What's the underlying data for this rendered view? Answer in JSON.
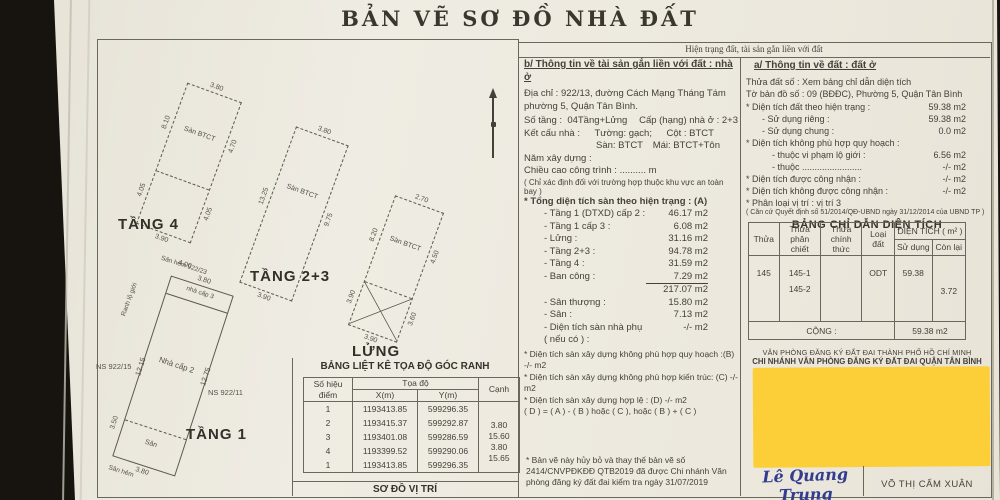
{
  "title": "BẢN VẼ SƠ ĐỒ NHÀ ĐẤT",
  "status_header": "Hiện trạng đất, tài sản gắn liền với đất",
  "building_info": {
    "heading": "b/ Thông tin về tài sản gắn liền với đất : nhà ở",
    "address1": "Địa chỉ : 922/13, đường Cách Mạng Tháng Tám",
    "address2": "phường 5, Quận Tân Bình.",
    "floors_label": "Số tầng :",
    "floors_value": "04Tầng+Lửng",
    "grade": "Cấp (hạng) nhà ở : 2+3",
    "structure_label": "Kết cấu nhà :",
    "wall": "Tường: gạch;",
    "column": "Cột : BTCT",
    "floor": "Sàn: BTCT",
    "roof": "Mái: BTCT+Tôn",
    "year": "Năm xây dựng :",
    "height": "Chiều cao công trình : .......... m",
    "height_note": "( Chỉ xác định đối với trường hợp thuộc khu vực an toàn bay )",
    "total_heading": "* Tổng diện tích sàn theo hiện trạng : (A)",
    "area_rows": [
      {
        "label": "- Tầng 1 (DTXD) cấp 2 :",
        "value": "46.17 m2"
      },
      {
        "label": "- Tầng 1 cấp 3 :",
        "value": "6.08 m2"
      },
      {
        "label": "- Lửng :",
        "value": "31.16 m2"
      },
      {
        "label": "- Tầng 2+3 :",
        "value": "94.78 m2"
      },
      {
        "label": "- Tầng 4 :",
        "value": "31.59 m2"
      },
      {
        "label": "- Ban công :",
        "value": "7.29 m2"
      }
    ],
    "subtotal": "217.07 m2",
    "extra_rows": [
      {
        "label": "- Sân thượng :",
        "value": "15.80 m2"
      },
      {
        "label": "- Sân :",
        "value": "7.13 m2"
      },
      {
        "label": "- Diện tích sàn nhà phụ ( nếu có ) :",
        "value": "-/- m2"
      }
    ],
    "note_b": "* Diện tích sàn xây dựng không phù hợp quy hoạch :(B) -/- m2",
    "note_c": "* Diện tích sàn xây dựng không phù hợp kiến trúc: (C) -/- m2",
    "note_d": "* Diện tích sàn xây dựng hợp lệ : (D)    -/- m2",
    "note_formula": "( D ) = ( A ) - ( B ) hoặc ( C ), hoặc ( B ) + ( C )",
    "footnote": "* Bản vẽ này hủy bỏ và thay thế bản vẽ số 2414/CNVPĐKĐĐ QTB2019 đã được Chi nhánh Văn phòng đăng ký đất đai kiểm tra ngày 31/07/2019"
  },
  "land_info": {
    "heading": "a/ Thông tin về đất : đất ở",
    "parcel": "Thửa đất số : Xem bảng chỉ dẫn diện tích",
    "map_sheet": "Tờ bản đồ số : 09 (BĐĐC), Phường 5, Quận Tân Bình",
    "rows": [
      {
        "label": "* Diện tích đất theo hiện trạng :",
        "value": "59.38 m2"
      },
      {
        "label": "- Sử dụng riêng :",
        "value": "59.38 m2"
      },
      {
        "label": "- Sử dụng chung :",
        "value": "0.0 m2"
      },
      {
        "label": "* Diện tích không phù hợp quy hoạch :",
        "value": ""
      },
      {
        "label": "- thuộc vi phạm lộ giới :",
        "value": "6.56 m2"
      },
      {
        "label": "- thuộc ........................",
        "value": "-/- m2"
      },
      {
        "label": "* Diện tích được công nhận :",
        "value": "-/- m2"
      },
      {
        "label": "* Diện tích không được công nhận :",
        "value": "-/- m2"
      },
      {
        "label": "* Phân loại vị trí : vị trí 3",
        "value": ""
      }
    ],
    "legal_ref": "( Căn cứ Quyết định số 51/2014/QĐ-UBND ngày 31/12/2014 của UBND TP )"
  },
  "area_table": {
    "title": "BẢNG CHỈ DẪN DIỆN TÍCH",
    "col_thua": "Thửa",
    "col_phan_chiet_1": "Thửa",
    "col_phan_chiet_2": "phân chiết",
    "col_chinh_thuc_1": "Thửa",
    "col_chinh_thuc_2": "chính thức",
    "col_loai_dat": "Loại đất",
    "col_dien_tich": "DIỆN TÍCH ( m² )",
    "col_su_dung": "Sử dụng",
    "col_con_lai": "Còn lại",
    "row": {
      "thua": "145",
      "phan_chiet1": "145-1",
      "phan_chiet2": "145-2",
      "chinh_thuc": "",
      "loai_dat": "ODT",
      "su_dung": "59.38",
      "con_lai": "3.72"
    },
    "total_label": "CỘNG :",
    "total_value": "59.38 m2"
  },
  "office": {
    "line1": "VĂN PHÒNG ĐĂNG KÝ ĐẤT ĐAI THÀNH PHỐ HỒ CHÍ MINH",
    "line2": "CHI NHÁNH VĂN PHÒNG ĐĂNG KÝ ĐẤT ĐAI QUẬN TÂN BÌNH"
  },
  "signatures": {
    "script": "Lê Quang Trung",
    "name": "VÕ THỊ CẨM XUÂN"
  },
  "coord_table": {
    "title": "BẢNG LIỆT KÊ TỌA ĐỘ GÓC RANH",
    "col_point_1": "Số hiệu",
    "col_point_2": "điểm",
    "col_toado": "Tọa độ",
    "col_x": "X(m)",
    "col_y": "Y(m)",
    "col_canh": "Cạnh",
    "rows": [
      {
        "p": "1",
        "x": "1193413.85",
        "y": "599296.35"
      },
      {
        "p": "2",
        "x": "1193415.37",
        "y": "599292.87"
      },
      {
        "p": "3",
        "x": "1193401.08",
        "y": "599286.59"
      },
      {
        "p": "4",
        "x": "1193399.52",
        "y": "599290.06"
      },
      {
        "p": "1",
        "x": "1193413.85",
        "y": "599296.35"
      }
    ],
    "edges": [
      "3.80",
      "15.60",
      "3.80",
      "15.65"
    ],
    "footer": "SƠ ĐỒ VỊ TRÍ"
  },
  "plans": {
    "tang4": {
      "label": "TẦNG 4",
      "room": "Sàn BTCT",
      "dim_top": "3.80",
      "dim_left_upper": "8.10",
      "dim_right_upper": "4.70",
      "dim_left_lower": "4.05",
      "dim_right_lower": "4.05",
      "dim_bottom": "3.90"
    },
    "tang23": {
      "label": "TẦNG 2+3",
      "room": "Sàn BTCT",
      "dim_top": "3.80",
      "dim_left": "13.25",
      "dim_right": "9.75",
      "dim_bottom": "3.90"
    },
    "lung": {
      "label": "LỬNG",
      "room": "Sàn BTCT",
      "dim_top": "2.70",
      "dim_left_upper": "8.20",
      "dim_right_upper": "4.50",
      "dim_left_lower": "3.90",
      "dim_right_lower": "3.60",
      "dim_bottom": "3.90"
    },
    "tang1": {
      "label": "TẦNG 1",
      "section_top": "nhà cấp 3",
      "section_main": "Nhà cấp 2",
      "section_bottom": "Sân",
      "ns_left": "NS 922/15",
      "ns_right": "NS 922/11",
      "dim_left": "12.15",
      "dim_right": "12.75",
      "dim_top": "3.80",
      "dim_top2": "4.00",
      "dim_bottom": "3.80",
      "dim_bottom2": "3.50",
      "annot_top": "Sân hẻm 922/23",
      "annot_left": "Ranh lộ giới",
      "annot_bottom": "Sân hẻm"
    }
  },
  "colors": {
    "paper": "#eceadf",
    "ink": "#45413a",
    "redaction_block": "#fccf38",
    "signature_ink": "#333d8f",
    "photo_background": "#17140f"
  }
}
